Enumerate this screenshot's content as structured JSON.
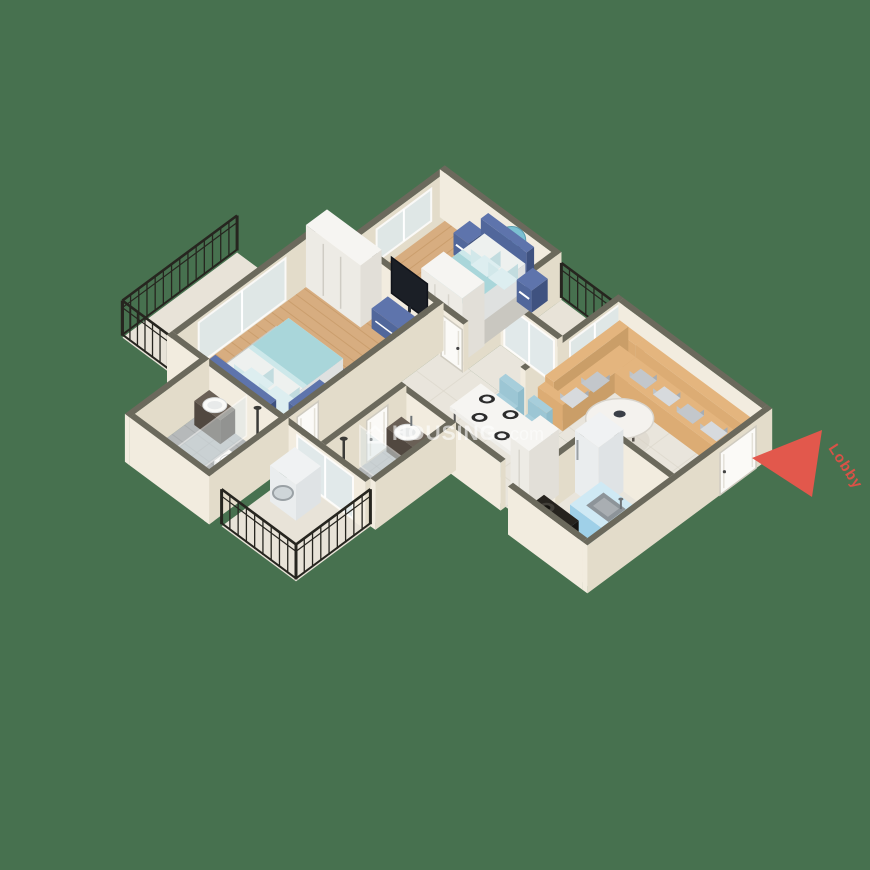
{
  "scene": {
    "title": "2BHK apartment 3D isometric floor plan render",
    "background": "#47714F",
    "watermark": {
      "icon": "house-icon",
      "brand": "HOUSING",
      "suffix": ".com"
    },
    "entry_label": {
      "text": "Lobby",
      "color": "#D95247",
      "arrow_color": "#E2584C"
    },
    "palette": {
      "bg": "#47714F",
      "wallTop": "#6B695C",
      "wallLight": "#F2ECDF",
      "wallShade": "#E3DCCA",
      "wood": "#D7AD80",
      "woodLine": "#C1925F",
      "tile": "#E9E5DC",
      "tileLine": "#DCD7CB",
      "bathTile": "#B6B9BA",
      "bathLine": "#9FA3A4",
      "paleFloor": "#E8E3D8",
      "rug": "#C9C7C0",
      "navy": "#51679B",
      "navyDark": "#3F5280",
      "navyTop": "#5E74AC",
      "bedLight": "#A9D6DA",
      "bedWhite": "#EEF1EF",
      "pillowLight": "#DDEEF0",
      "sofaTop": "#E4B57E",
      "sofaSE": "#CA9E68",
      "sofaSW": "#DCAC74",
      "pillowGray": "#C3C7CB",
      "pillowGray2": "#D7DADD",
      "chair": "#A7CEDB",
      "chairSide": "#8FBCCB",
      "white": "#F6F5F2",
      "whiteSE": "#E2DFD8",
      "whiteSW": "#EDEBE5",
      "counterBlue": "#9FD0E8",
      "counterBlueSE": "#8FC6E0",
      "counterTop": "#CFE9F4",
      "steel": "#8D9499",
      "stoveTop": "#26231E",
      "stoveSE": "#171512",
      "stoveSW": "#1D1B17",
      "glass": "#DFE9EC",
      "rail": "#26251F",
      "mirror": "#7CC0D2",
      "darkWood": "#5A5048",
      "watermarkColor": "#FFFFFF"
    },
    "rooms": [
      {
        "name": "bedroom-1",
        "floor": "wood",
        "furniture": [
          "double-bed",
          "two-nightstands",
          "round-wall-mirror",
          "wardrobe",
          "rug",
          "window"
        ]
      },
      {
        "name": "balcony-1",
        "floor": "pale-tile",
        "furniture": [
          "iron-railing",
          "sliding-glass-door"
        ]
      },
      {
        "name": "living-room",
        "floor": "marble-tile",
        "furniture": [
          "l-shaped-sofa",
          "throw-pillows",
          "round-coffee-table"
        ]
      },
      {
        "name": "balcony-2",
        "floor": "pale-tile",
        "furniture": [
          "iron-railing",
          "sliding-glass-door"
        ]
      },
      {
        "name": "dining-area",
        "floor": "marble-tile",
        "furniture": [
          "dining-table",
          "four-chairs",
          "five-plates"
        ]
      },
      {
        "name": "kitchen",
        "floor": "marble-tile",
        "furniture": [
          "refrigerator",
          "blue-sink-counter",
          "gas-stove",
          "tall-cabinet"
        ]
      },
      {
        "name": "bedroom-2",
        "floor": "wood",
        "furniture": [
          "double-bed",
          "sliding-wardrobe",
          "wall-tv",
          "tv-console",
          "dresser",
          "rug"
        ]
      },
      {
        "name": "bathroom-1",
        "floor": "gray-tile",
        "furniture": [
          "vanity-basin",
          "toilet",
          "shower",
          "glass-partition"
        ]
      },
      {
        "name": "bathroom-2",
        "floor": "gray-tile",
        "furniture": [
          "vanity-basin",
          "toilet",
          "shower",
          "glass-partition"
        ]
      },
      {
        "name": "utility-balcony",
        "floor": "pale-tile",
        "furniture": [
          "iron-railing",
          "washing-machine",
          "sliding-glass-door"
        ]
      }
    ]
  }
}
